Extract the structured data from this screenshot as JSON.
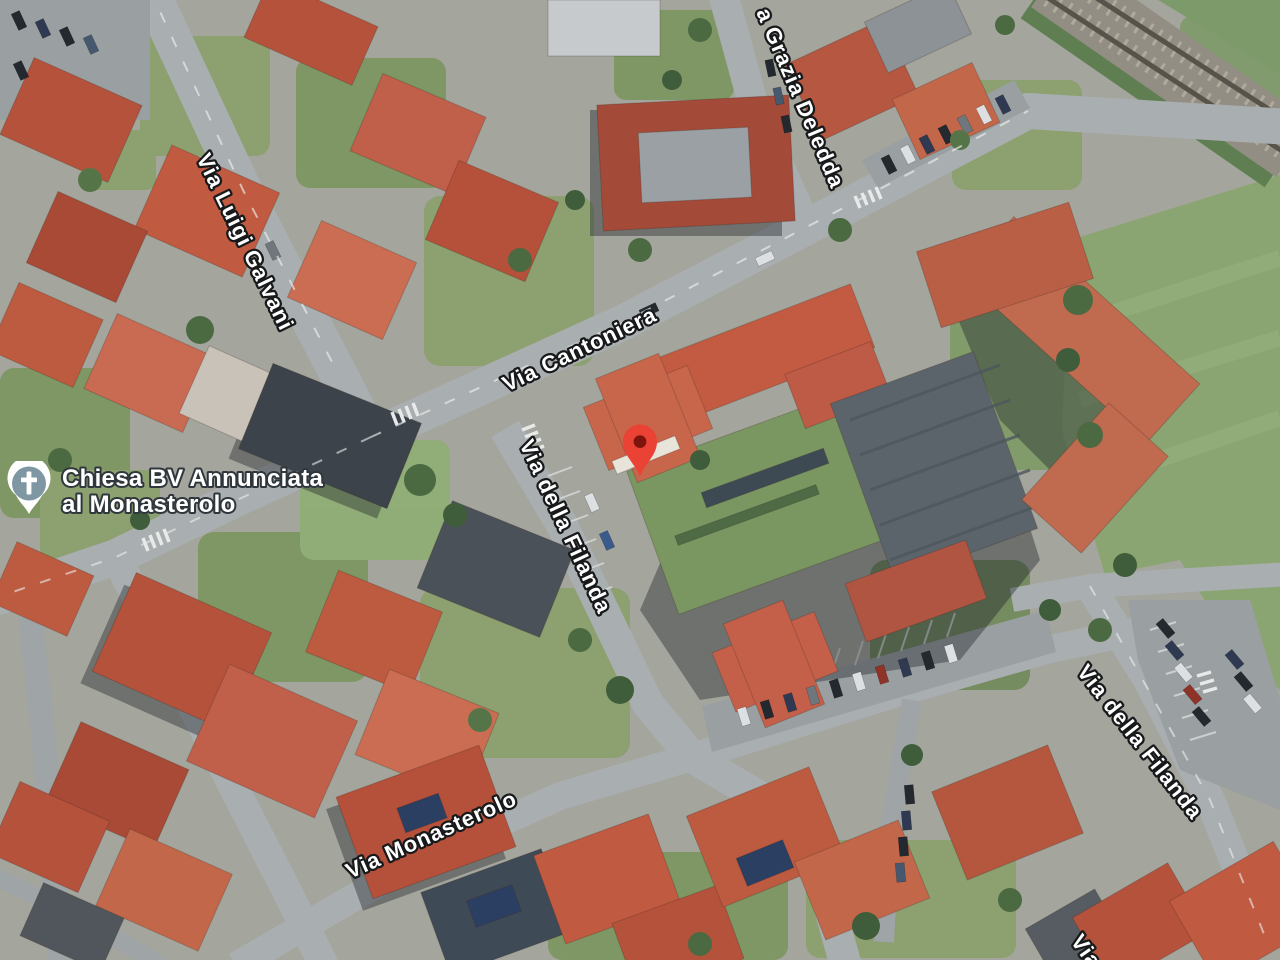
{
  "map": {
    "view_type": "satellite",
    "poi_church": {
      "label_line1": "Chiesa BV Annunciata",
      "label_line2": "al Monasterolo",
      "icon": "church-cross-icon",
      "icon_circle_color": "#7E97A3",
      "icon_pin_color": "#FFFFFF"
    },
    "marker": {
      "icon": "red-map-pin",
      "pin_color": "#EA4335",
      "dot_color": "#7E150D"
    },
    "road_labels": [
      {
        "text": "Via Luigi Galvani",
        "x": 196,
        "y": 158,
        "rotation": 64
      },
      {
        "text": "Via Cantoniera",
        "x": 507,
        "y": 392,
        "rotation": -25.5
      },
      {
        "text": "a Grazia Deledda",
        "x": 756,
        "y": 12,
        "rotation": 67
      },
      {
        "text": "Via della Filanda",
        "x": 519,
        "y": 444,
        "rotation": 65
      },
      {
        "text": "Via Monasterolo",
        "x": 350,
        "y": 879,
        "rotation": -24
      },
      {
        "text": "Via della Filanda",
        "x": 1076,
        "y": 672,
        "rotation": 52
      },
      {
        "text": "Via",
        "x": 1070,
        "y": 941,
        "rotation": 55
      }
    ],
    "label_text_color": "#FFFFFF",
    "label_outline_color": "#17191B"
  }
}
